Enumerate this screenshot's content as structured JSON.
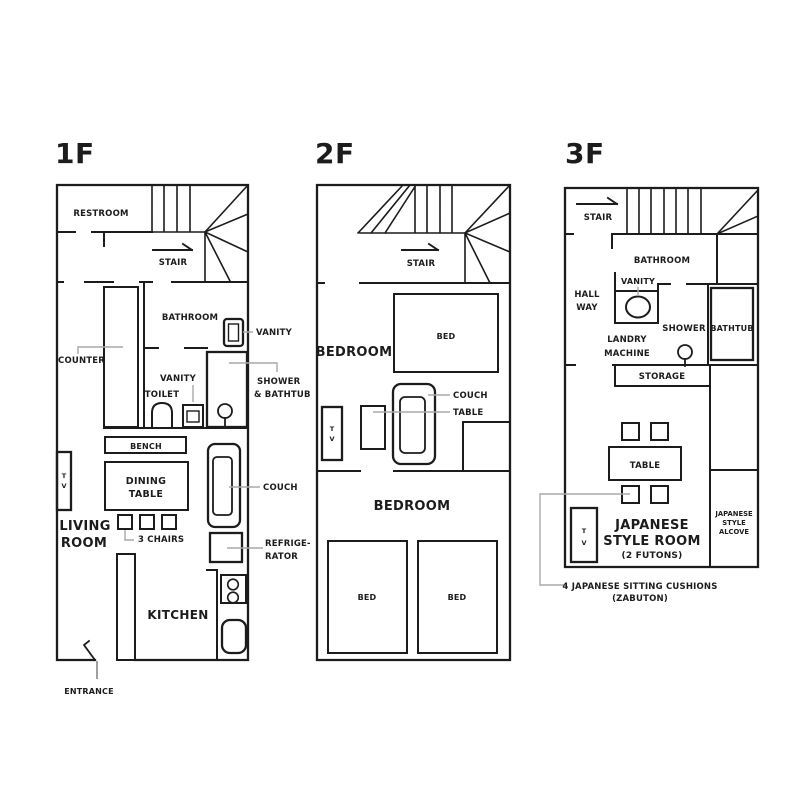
{
  "colors": {
    "line": "#1c1c1c",
    "leader": "#a9a9a9",
    "background": "#ffffff"
  },
  "floors": [
    {
      "title": "1F",
      "labels": {
        "restroom": "RESTROOM",
        "stair": "STAIR",
        "bathroom": "BATHROOM",
        "vanity_top": "VANITY",
        "counter": "COUNTER",
        "toilet": "TOILET",
        "vanity_mid": "VANITY",
        "shower_1": "SHOWER",
        "shower_2": "& BATHTUB",
        "bench": "BENCH",
        "dining_1": "DINING",
        "dining_2": "TABLE",
        "tv_1": "T",
        "tv_2": "V",
        "living_1": "LIVING",
        "living_2": "ROOM",
        "chairs": "3 CHAIRS",
        "couch": "COUCH",
        "fridge_1": "REFRIGE-",
        "fridge_2": "RATOR",
        "kitchen": "KITCHEN",
        "entrance": "ENTRANCE"
      }
    },
    {
      "title": "2F",
      "labels": {
        "stair": "STAIR",
        "bedroom_top": "BEDROOM",
        "bed_top": "BED",
        "tv_1": "T",
        "tv_2": "V",
        "couch": "COUCH",
        "table": "TABLE",
        "bedroom_bottom": "BEDROOM",
        "bed_left": "BED",
        "bed_right": "BED"
      }
    },
    {
      "title": "3F",
      "labels": {
        "stair": "STAIR",
        "bathroom": "BATHROOM",
        "vanity": "VANITY",
        "hall_1": "HALL",
        "hall_2": "WAY",
        "laundry_1": "LANDRY",
        "laundry_2": "MACHINE",
        "shower": "SHOWER",
        "bathtub": "BATHTUB",
        "storage": "STORAGE",
        "table": "TABLE",
        "tv_1": "T",
        "tv_2": "V",
        "room_1": "JAPANESE",
        "room_2": "STYLE ROOM",
        "room_3": "(2 FUTONS)",
        "alcove_1": "JAPANESE",
        "alcove_2": "STYLE",
        "alcove_3": "ALCOVE",
        "callout_1": "4 JAPANESE SITTING CUSHIONS",
        "callout_2": "(ZABUTON)"
      }
    }
  ]
}
